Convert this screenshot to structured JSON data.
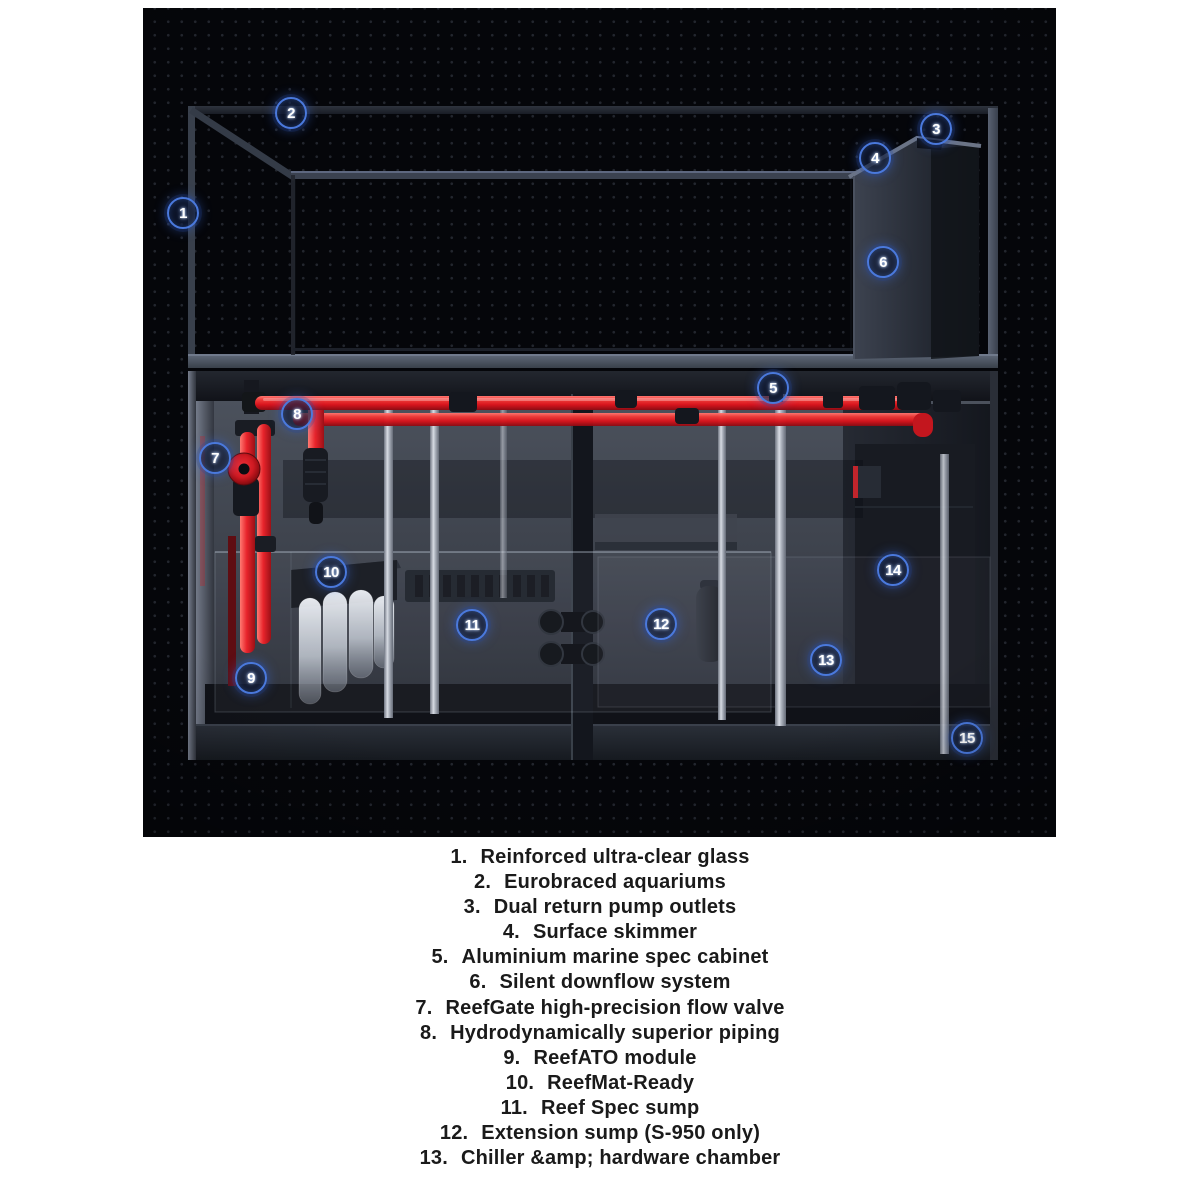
{
  "figure": {
    "description": "Aquarium system cutaway render on black dotted background with numbered callouts",
    "colors": {
      "background": "#05060a",
      "dot": "#8c96af",
      "pipe_red": "#e31e26",
      "valve_red": "#cf1a22",
      "badge_ring": "#4a79dd",
      "frame_gray": "#4a5160",
      "roll_white": "#e9edf2"
    },
    "callouts": [
      {
        "n": "1",
        "x": 40,
        "y": 205
      },
      {
        "n": "2",
        "x": 148,
        "y": 105
      },
      {
        "n": "3",
        "x": 793,
        "y": 121
      },
      {
        "n": "4",
        "x": 732,
        "y": 150
      },
      {
        "n": "5",
        "x": 630,
        "y": 380
      },
      {
        "n": "6",
        "x": 740,
        "y": 254
      },
      {
        "n": "7",
        "x": 72,
        "y": 450
      },
      {
        "n": "8",
        "x": 154,
        "y": 406
      },
      {
        "n": "9",
        "x": 108,
        "y": 670
      },
      {
        "n": "10",
        "x": 188,
        "y": 564
      },
      {
        "n": "11",
        "x": 329,
        "y": 617
      },
      {
        "n": "12",
        "x": 518,
        "y": 616
      },
      {
        "n": "13",
        "x": 683,
        "y": 652
      },
      {
        "n": "14",
        "x": 750,
        "y": 562
      },
      {
        "n": "15",
        "x": 824,
        "y": 730
      }
    ]
  },
  "features": {
    "items": [
      {
        "num": "1.",
        "label": "Reinforced ultra-clear glass"
      },
      {
        "num": "2.",
        "label": "Eurobraced aquariums"
      },
      {
        "num": "3.",
        "label": "Dual return pump outlets"
      },
      {
        "num": "4.",
        "label": "Surface skimmer"
      },
      {
        "num": "5.",
        "label": "Aluminium marine spec cabinet"
      },
      {
        "num": "6.",
        "label": "Silent downflow system"
      },
      {
        "num": "7.",
        "label": "ReefGate high-precision flow valve"
      },
      {
        "num": "8.",
        "label": "Hydrodynamically superior piping"
      },
      {
        "num": "9.",
        "label": "ReefATO module"
      },
      {
        "num": "10.",
        "label": "ReefMat-Ready"
      },
      {
        "num": "11.",
        "label": "Reef Spec sump"
      },
      {
        "num": "12.",
        "label": "Extension sump (S-950 only)"
      },
      {
        "num": "13.",
        "label": "Chiller &amp; hardware chamber"
      }
    ]
  }
}
